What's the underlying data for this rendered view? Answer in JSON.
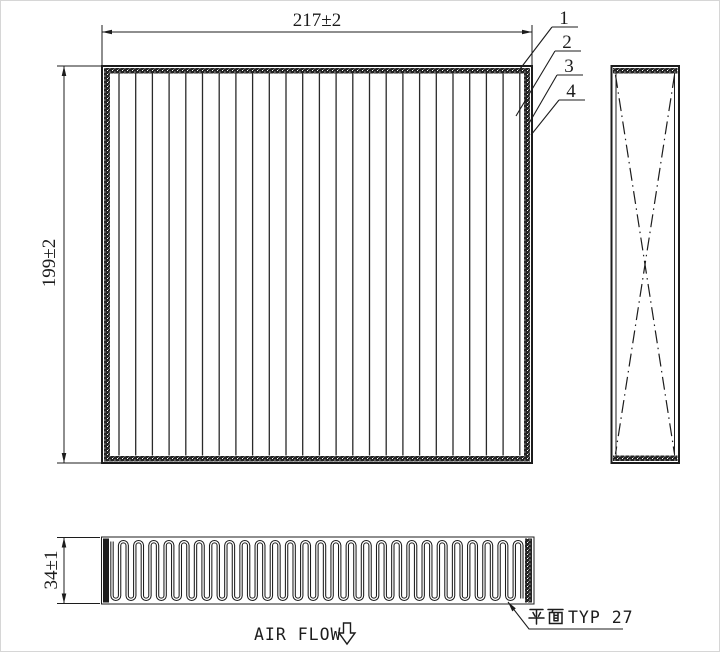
{
  "page": {
    "background": "#ffffff",
    "line_color": "#1c1c1c"
  },
  "front_view": {
    "width_dimension": "217±2",
    "height_dimension": "199±2",
    "pleat_line_count": 25
  },
  "callouts": {
    "items": [
      {
        "label": "1"
      },
      {
        "label": "2"
      },
      {
        "label": "3"
      },
      {
        "label": "4"
      }
    ]
  },
  "side_view": {
    "cross_pattern": "dash-dot X"
  },
  "bottom_view": {
    "depth_dimension": "34±1",
    "pleat_count": 27,
    "pleat_note": {
      "full": "平面 TYP 27",
      "cjk": "平面",
      "latin": "TYP 27"
    }
  },
  "footer": {
    "air_flow_label": "AIR FLOW",
    "arrow_symbol": "⇩"
  }
}
